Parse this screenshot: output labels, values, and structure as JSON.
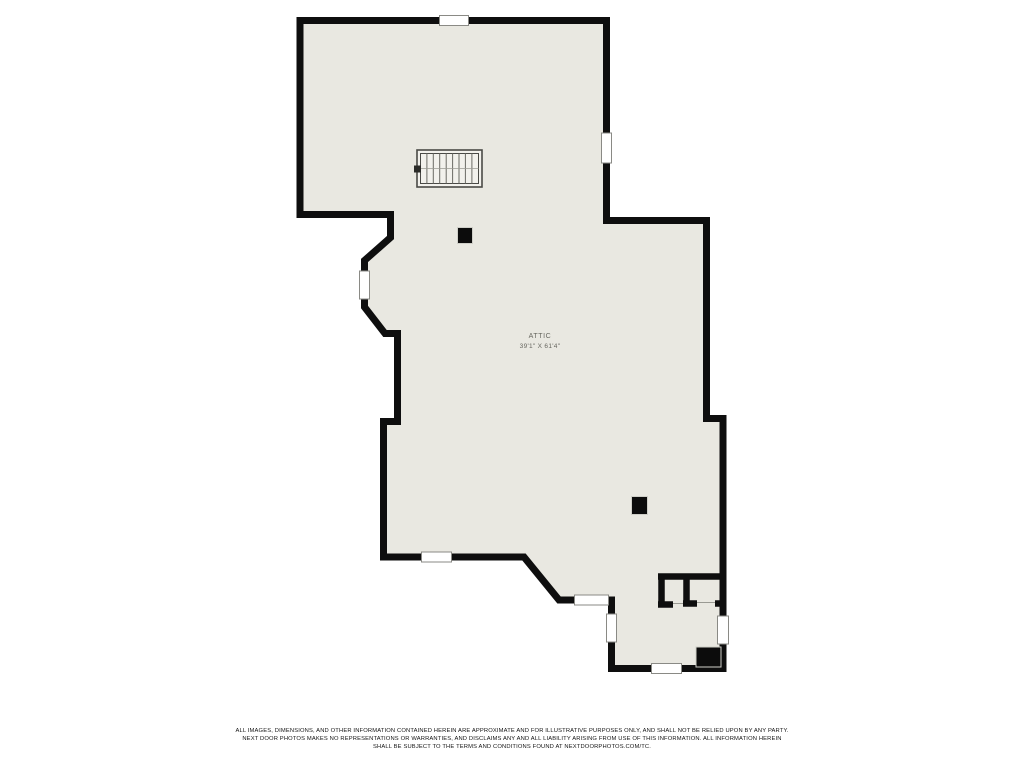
{
  "room": {
    "name": "ATTIC",
    "dimensions": "39'1\" X 61'4\""
  },
  "disclaimer": {
    "line1": "ALL IMAGES, DIMENSIONS, AND OTHER INFORMATION CONTAINED HEREIN ARE APPROXIMATE AND FOR ILLUSTRATIVE PURPOSES ONLY, AND SHALL NOT BE RELIED UPON BY ANY PARTY.",
    "line2": "NEXT DOOR PHOTOS MAKES NO REPRESENTATIONS OR WARRANTIES, AND DISCLAIMS ANY AND ALL LIABILITY ARISING FROM USE OF THIS INFORMATION. ALL INFORMATION HEREIN",
    "line3": "SHALL BE SUBJECT TO THE TERMS AND CONDITIONS FOUND AT NEXTDOORPHOTOS.COM/TC."
  },
  "colors": {
    "background": "#ffffff",
    "floor_fill": "#e9e8e1",
    "wall": "#0e0e0e",
    "window_border": "#8a8a85",
    "label_text": "#66665f",
    "disclaimer_text": "#141414"
  }
}
